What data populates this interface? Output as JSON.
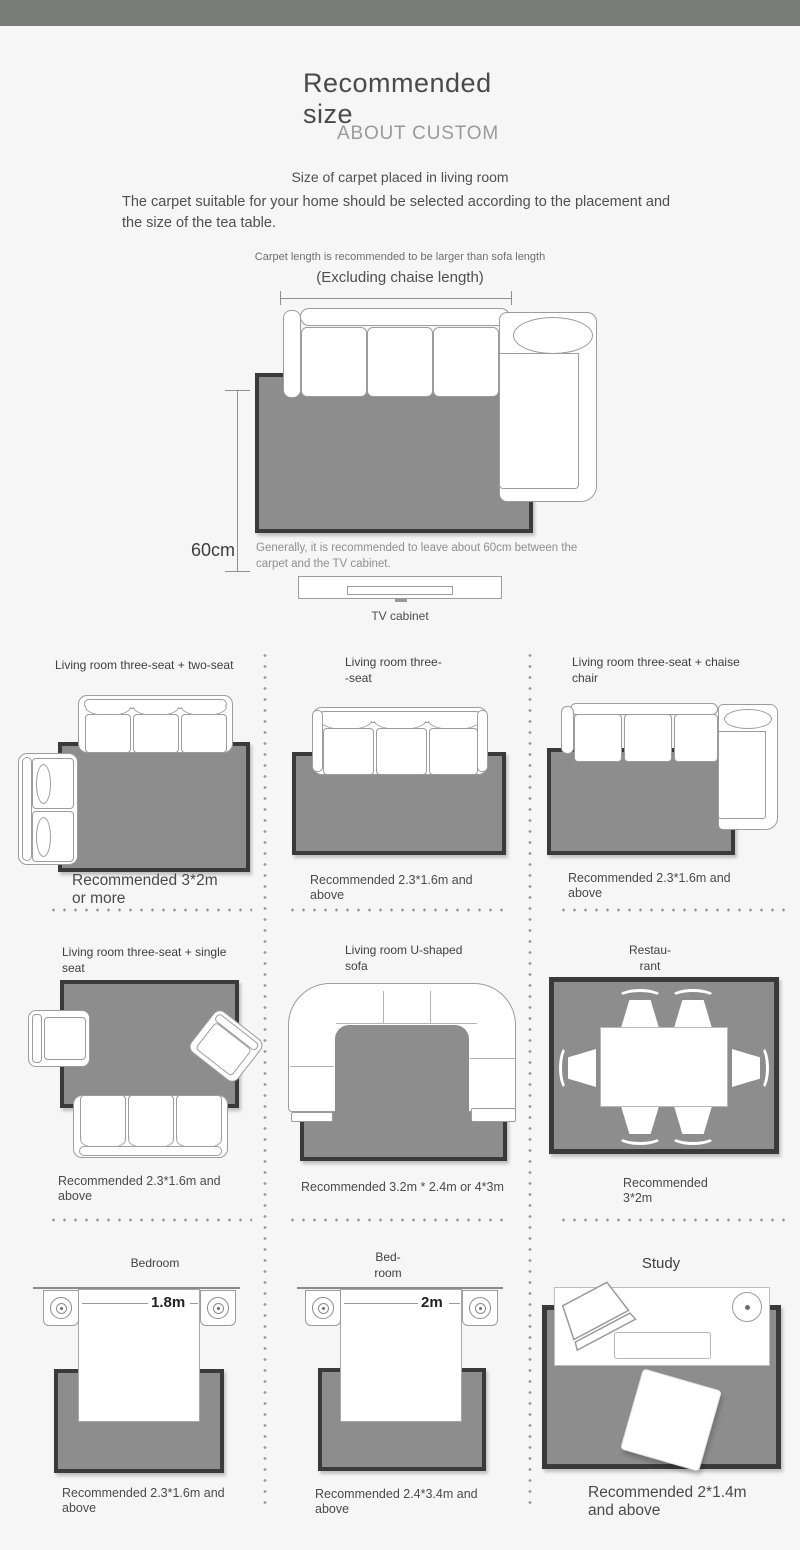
{
  "colors": {
    "top_bar": "#7a7c7a",
    "background": "#f5f6f5",
    "carpet_fill": "#8d8d8d",
    "carpet_border": "#3a3a3a",
    "furniture_outline": "#9c9c9c"
  },
  "header": {
    "title": "Recommended size",
    "subtitle": "ABOUT CUSTOM",
    "section_title": "Size of carpet placed in living room",
    "description": "The carpet suitable for your home should be selected according to the placement and the size of the tea table."
  },
  "hero": {
    "note_line1": "Carpet length is recommended to be larger than sofa length",
    "note_line2": "(Excluding chaise length)",
    "gap_label": "60cm",
    "gap_note": "Generally, it is recommended to leave about 60cm between the carpet and the TV cabinet.",
    "tv_label": "TV cabinet"
  },
  "grid": {
    "cells": [
      {
        "title": "Living room three-seat + two-seat",
        "caption": "Recommended 3*2m\nor more"
      },
      {
        "title": "Living room three-\n-seat",
        "caption": "Recommended 2.3*1.6m and\nabove"
      },
      {
        "title": "Living room three-seat + chaise\nchair",
        "caption": "Recommended 2.3*1.6m and\nabove"
      },
      {
        "title": "Living room three-seat + single\nseat",
        "caption": "Recommended 2.3*1.6m and\nabove"
      },
      {
        "title": "Living room U-shaped\nsofa",
        "caption": "Recommended 3.2m * 2.4m or 4*3m"
      },
      {
        "title": "Restau-\nrant",
        "caption": "Recommended\n3*2m"
      },
      {
        "title": "Bedroom",
        "caption": "Recommended 2.3*1.6m and\nabove",
        "dim": "1.8m"
      },
      {
        "title": "Bed-\nroom",
        "caption": "Recommended 2.4*3.4m and\nabove",
        "dim": "2m"
      },
      {
        "title": "Study",
        "caption": "Recommended 2*1.4m\nand above"
      }
    ]
  }
}
